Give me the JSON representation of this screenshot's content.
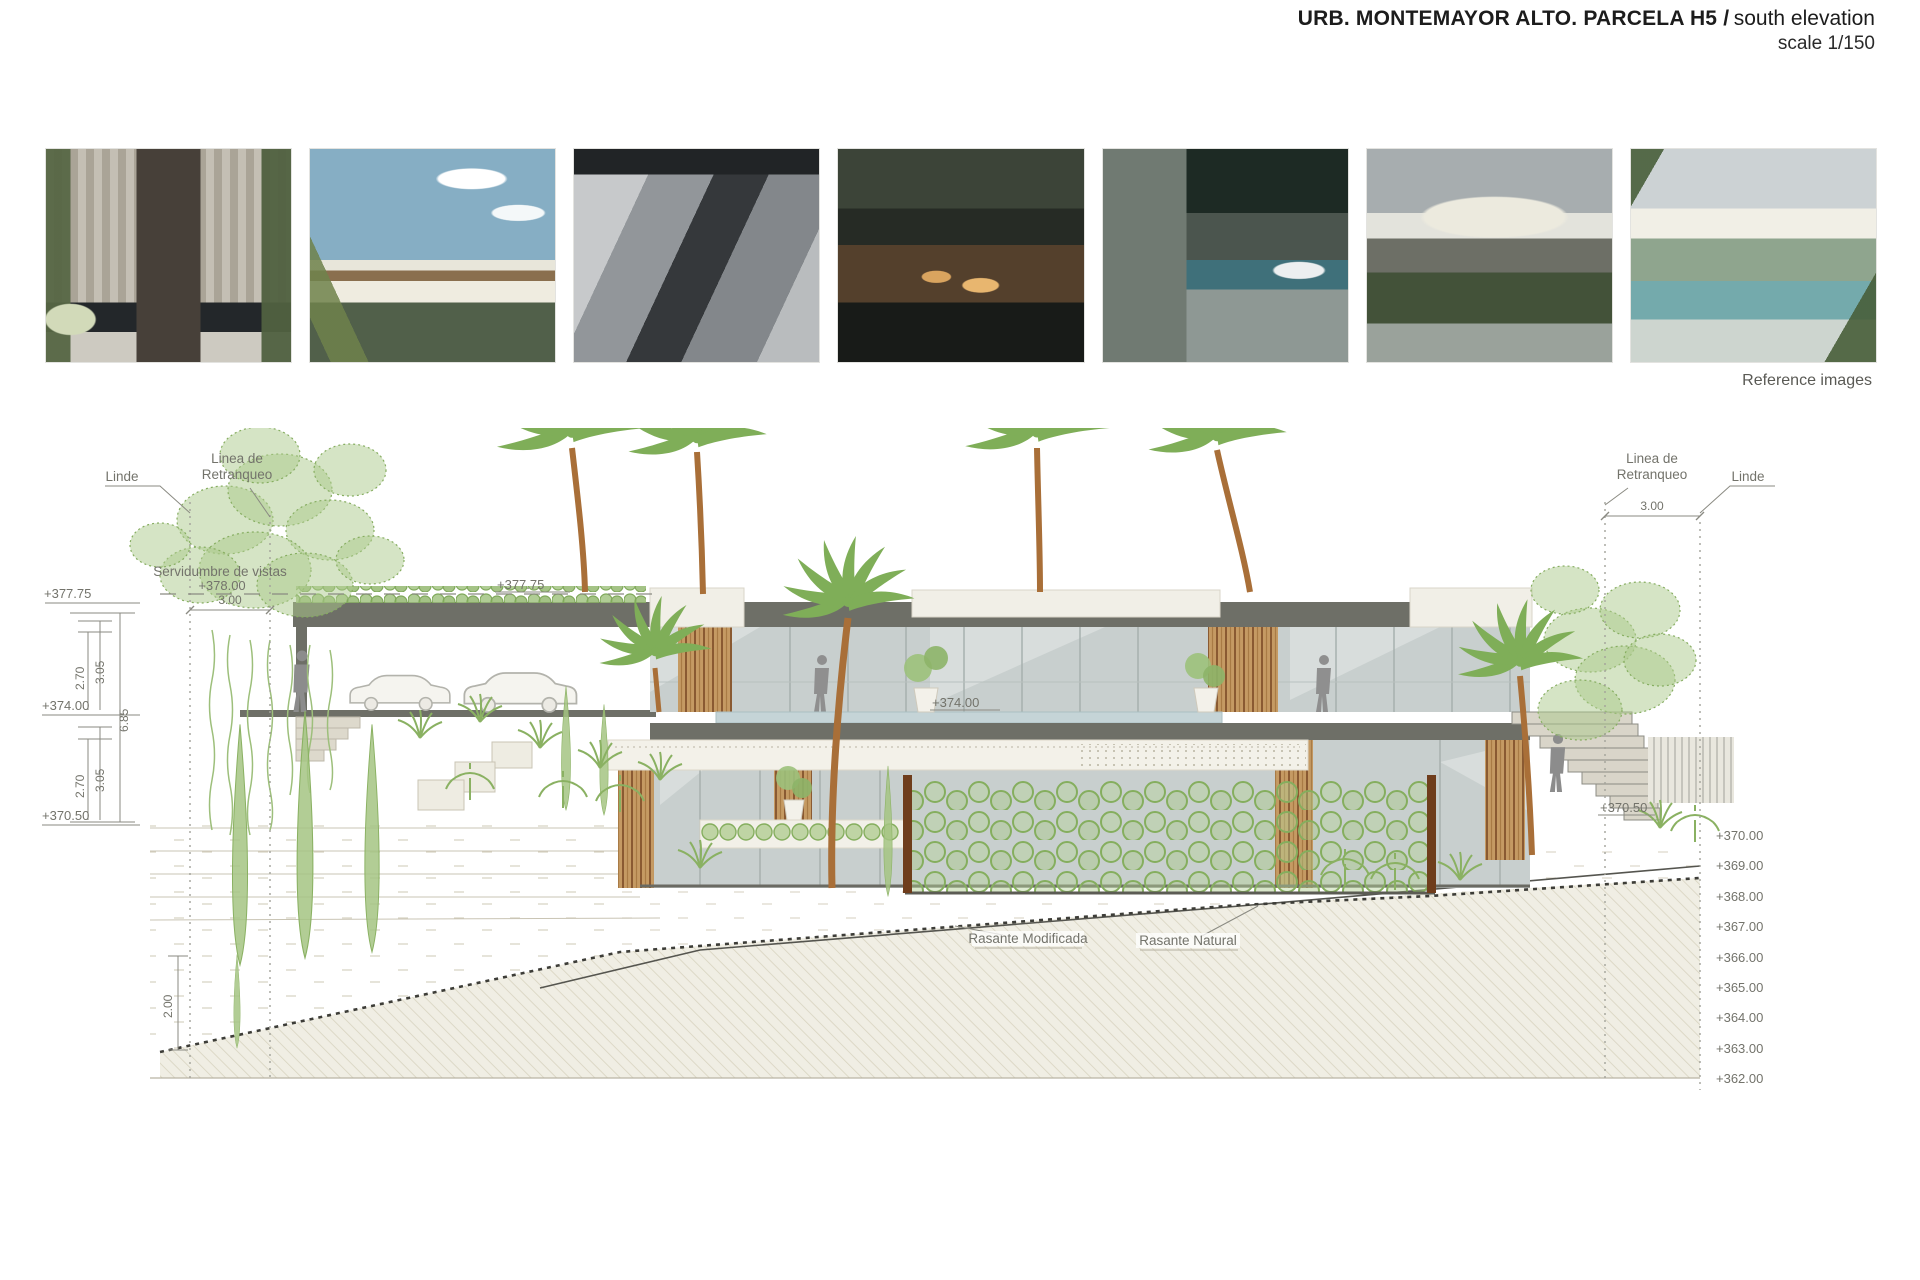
{
  "header": {
    "title_bold": "URB. MONTEMAYOR ALTO. PARCELA H5 /",
    "title_regular": "south elevation",
    "scale": "scale 1/150"
  },
  "reference_images": {
    "caption": "Reference images",
    "items": [
      {
        "desc": "Courtyard entrance with slatted pergola, reflecting pool and tropical planting"
      },
      {
        "desc": "Flat-roof villa render with palm tree and bright sky"
      },
      {
        "desc": "Concrete entrance volume close-up in grey tones"
      },
      {
        "desc": "Evening terrace with warm wood lighting, pool and foliage"
      },
      {
        "desc": "Night patio with stone wall, lap pool and white car"
      },
      {
        "desc": "Stone and glass house with curved white roof in garden"
      },
      {
        "desc": "White canopy roof over pool terrace with tropical plants"
      }
    ]
  },
  "elevation": {
    "annotations": {
      "linde": "Linde",
      "retranqueo_l1": "Linea de",
      "retranqueo_l2": "Retranqueo",
      "servidumbre": "Servidumbre de vistas",
      "servidumbre_level": "+378.00",
      "setback_dim": "3.00",
      "rasante_modificada": "Rasante Modificada",
      "rasante_natural": "Rasante Natural",
      "small_tree_height": "2.00"
    },
    "levels": {
      "roof": "+377.75",
      "deck": "+374.00",
      "garden": "+370.50"
    },
    "dims": {
      "d270": "2.70",
      "d305": "3.05",
      "total": "6.85"
    },
    "right_scale": [
      "+370.00",
      "+369.00",
      "+368.00",
      "+367.00",
      "+366.00",
      "+365.00",
      "+364.00",
      "+363.00",
      "+362.00"
    ],
    "colors": {
      "fascia": "#6e6f67",
      "glass": "#c8cfce",
      "wood": "#c59a63",
      "vegetation": "#85ae5e",
      "pool": "#c5d4d7",
      "earth_hatch": "#d8d3c0",
      "post_brown": "#6f3d1c"
    }
  }
}
